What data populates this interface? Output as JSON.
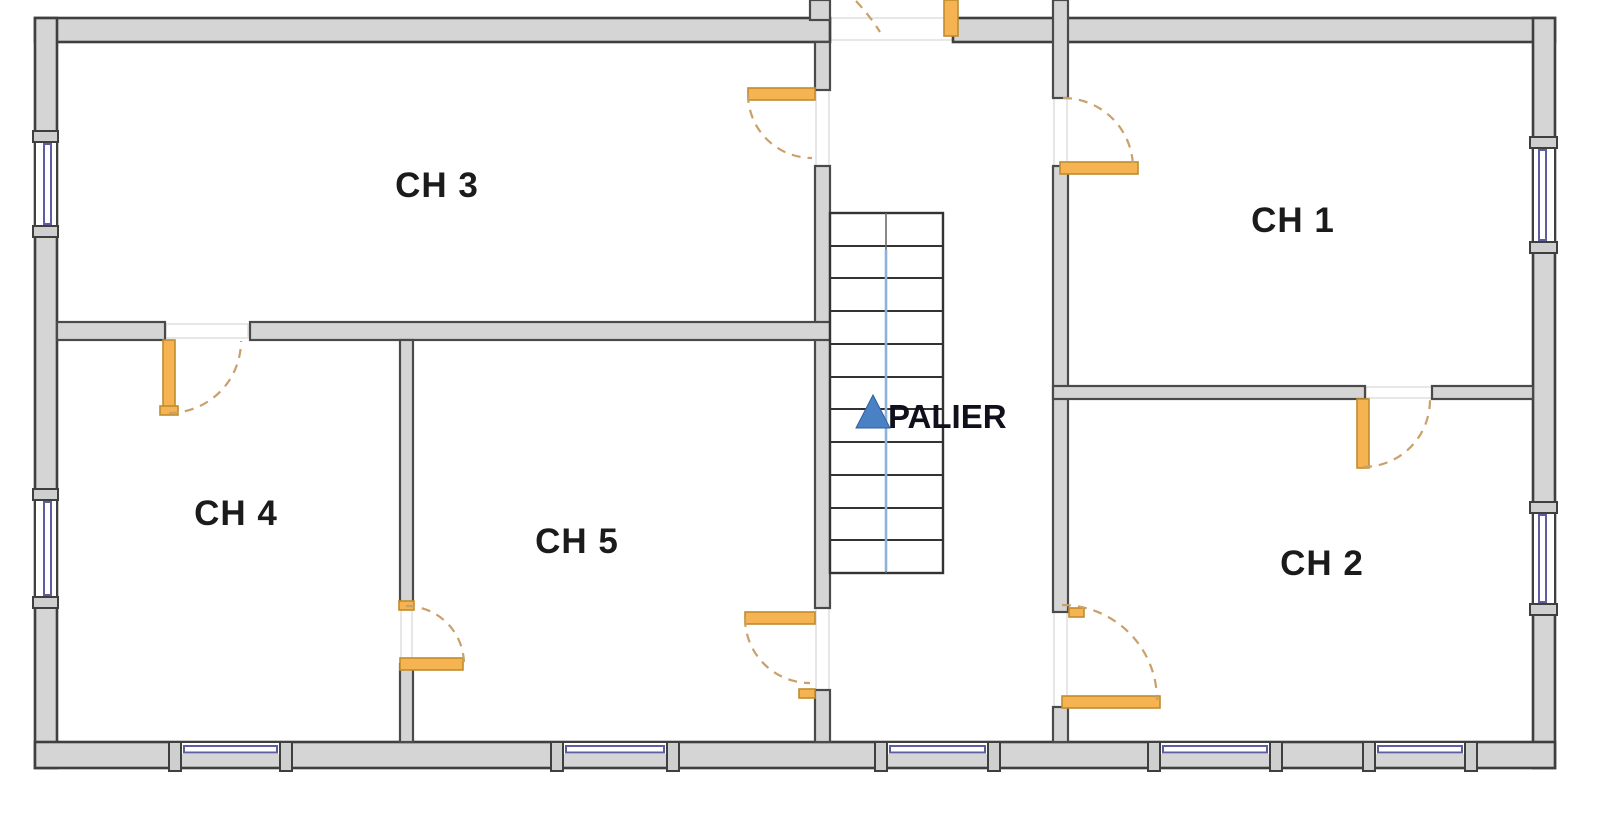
{
  "plan": {
    "kind": "floor-plan",
    "rooms": {
      "ch1": {
        "label": "CH 1"
      },
      "ch2": {
        "label": "CH 2"
      },
      "ch3": {
        "label": "CH 3"
      },
      "ch4": {
        "label": "CH 4"
      },
      "ch5": {
        "label": "CH 5"
      },
      "landing": {
        "label": "PALIER"
      }
    },
    "stairs": {
      "tread_count": 11,
      "arrow_direction": "up"
    },
    "counts": {
      "bedrooms": 5,
      "windows_visible": 9,
      "doors_visible": 8
    },
    "colors": {
      "wall_fill": "#d5d5d5",
      "wall_outline": "#3f3f3f",
      "door_fill": "#f5b351",
      "door_swing": "#c9a06a",
      "window_glazing": "#5d5da1",
      "stair_guide": "#8fb2d9",
      "direction_arrow": "#4a80c4",
      "label_text": "#1b1b1b"
    }
  }
}
